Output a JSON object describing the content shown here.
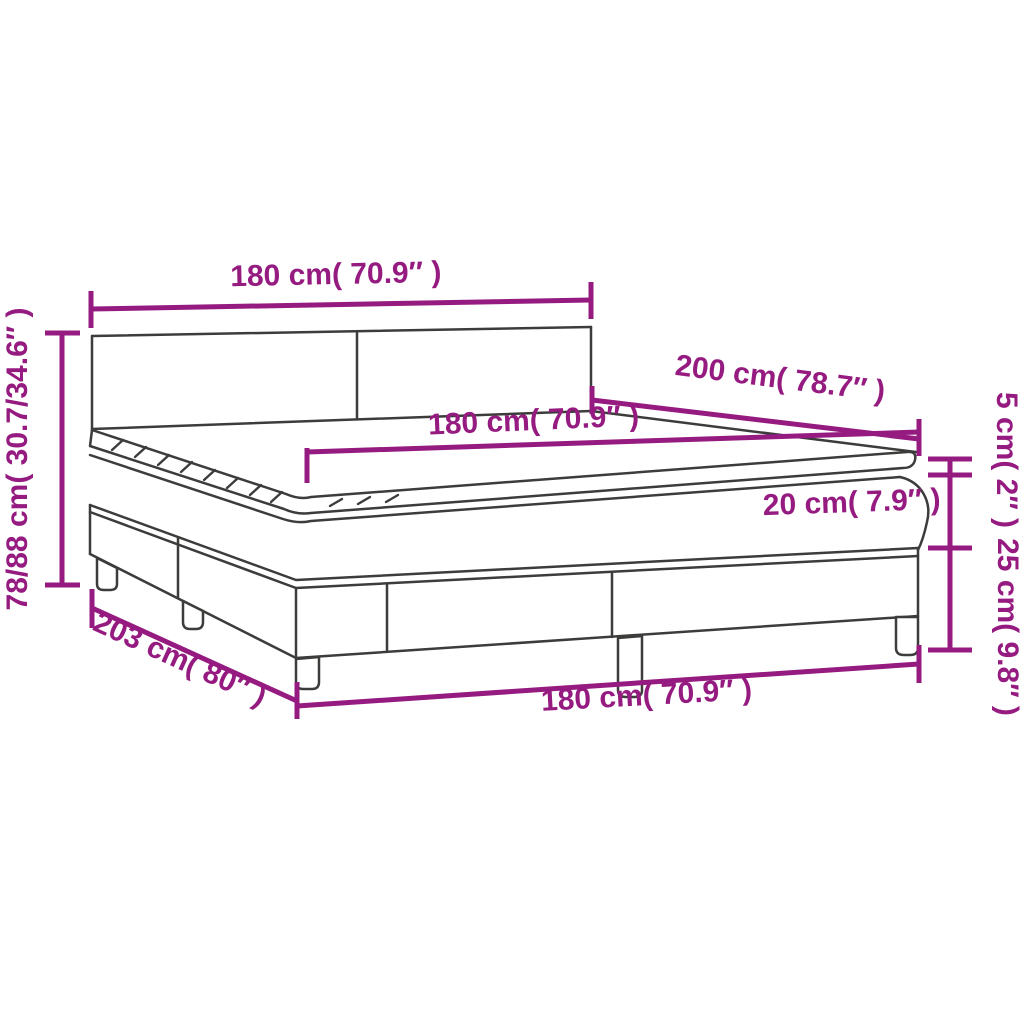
{
  "diagram": {
    "title": "Box spring bed with mattress and topper - dimension diagram",
    "colors": {
      "dimension_accent": "#951b80",
      "outline": "#3c3c3b",
      "background": "#ffffff"
    },
    "labels": {
      "headboard_width": "180 cm( 70.9″ )",
      "bed_height": "78/88 cm( 30.7/34.6″ )",
      "bed_length": "200 cm( 78.7″ )",
      "mattress_width": "180 cm( 70.9″ )",
      "mattress_height": "20 cm( 7.9″ )",
      "topper_height": "5 cm( 2″ )",
      "base_height": "25 cm( 9.8″ )",
      "frame_length": "203 cm( 80″ )",
      "frame_width": "180 cm( 70.9″ )"
    }
  }
}
